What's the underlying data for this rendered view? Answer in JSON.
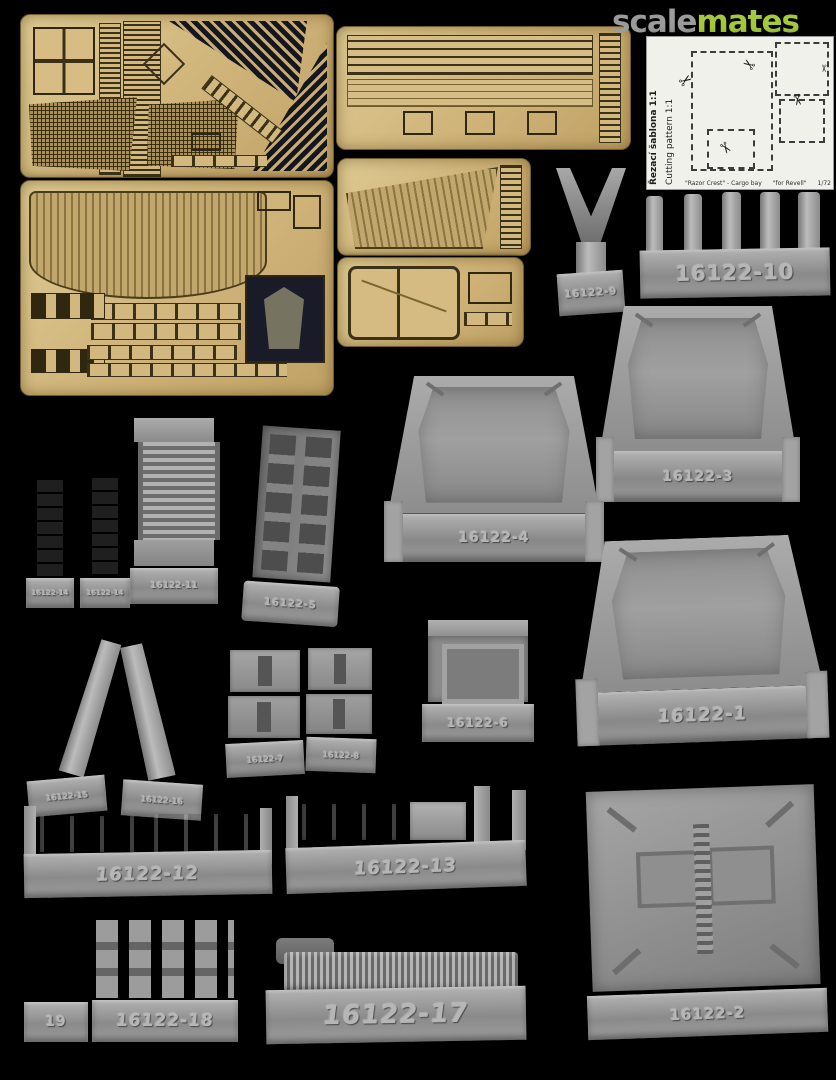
{
  "page": {
    "background": "#000000"
  },
  "logo": {
    "scale": "scale",
    "mates": "mates",
    "scale_color": "#9b9b9b",
    "mates_color": "#a4c93b"
  },
  "cutting_card": {
    "title_cs": "Řezací šablona 1:1",
    "title_en": "Cutting pattern 1:1",
    "caption_product": "\"Razor Crest\" - Cargo bay",
    "caption_for": "\"for Revell\"",
    "caption_scale": "1/72",
    "scissors": "✂"
  },
  "labels": {
    "p1": "16122-1",
    "p2": "16122-2",
    "p3": "16122-3",
    "p4": "16122-4",
    "p5": "16122-5",
    "p6": "16122-6",
    "p7": "16122-7",
    "p8": "16122-8",
    "p9": "16122-9",
    "p10": "16122-10",
    "p11": "16122-11",
    "p12": "16122-12",
    "p13": "16122-13",
    "p14a": "16122-14",
    "p14b": "16122-14",
    "p15": "16122-15",
    "p16": "16122-16",
    "p17": "16122-17",
    "p18": "16122-18",
    "p19": "19"
  },
  "colors": {
    "background": "#000000",
    "brass_fret": "#d2b87e",
    "brass_etch_dark": "#2f2710",
    "resin_gray": "#9a9a9a",
    "logo_green": "#a4c93b"
  }
}
